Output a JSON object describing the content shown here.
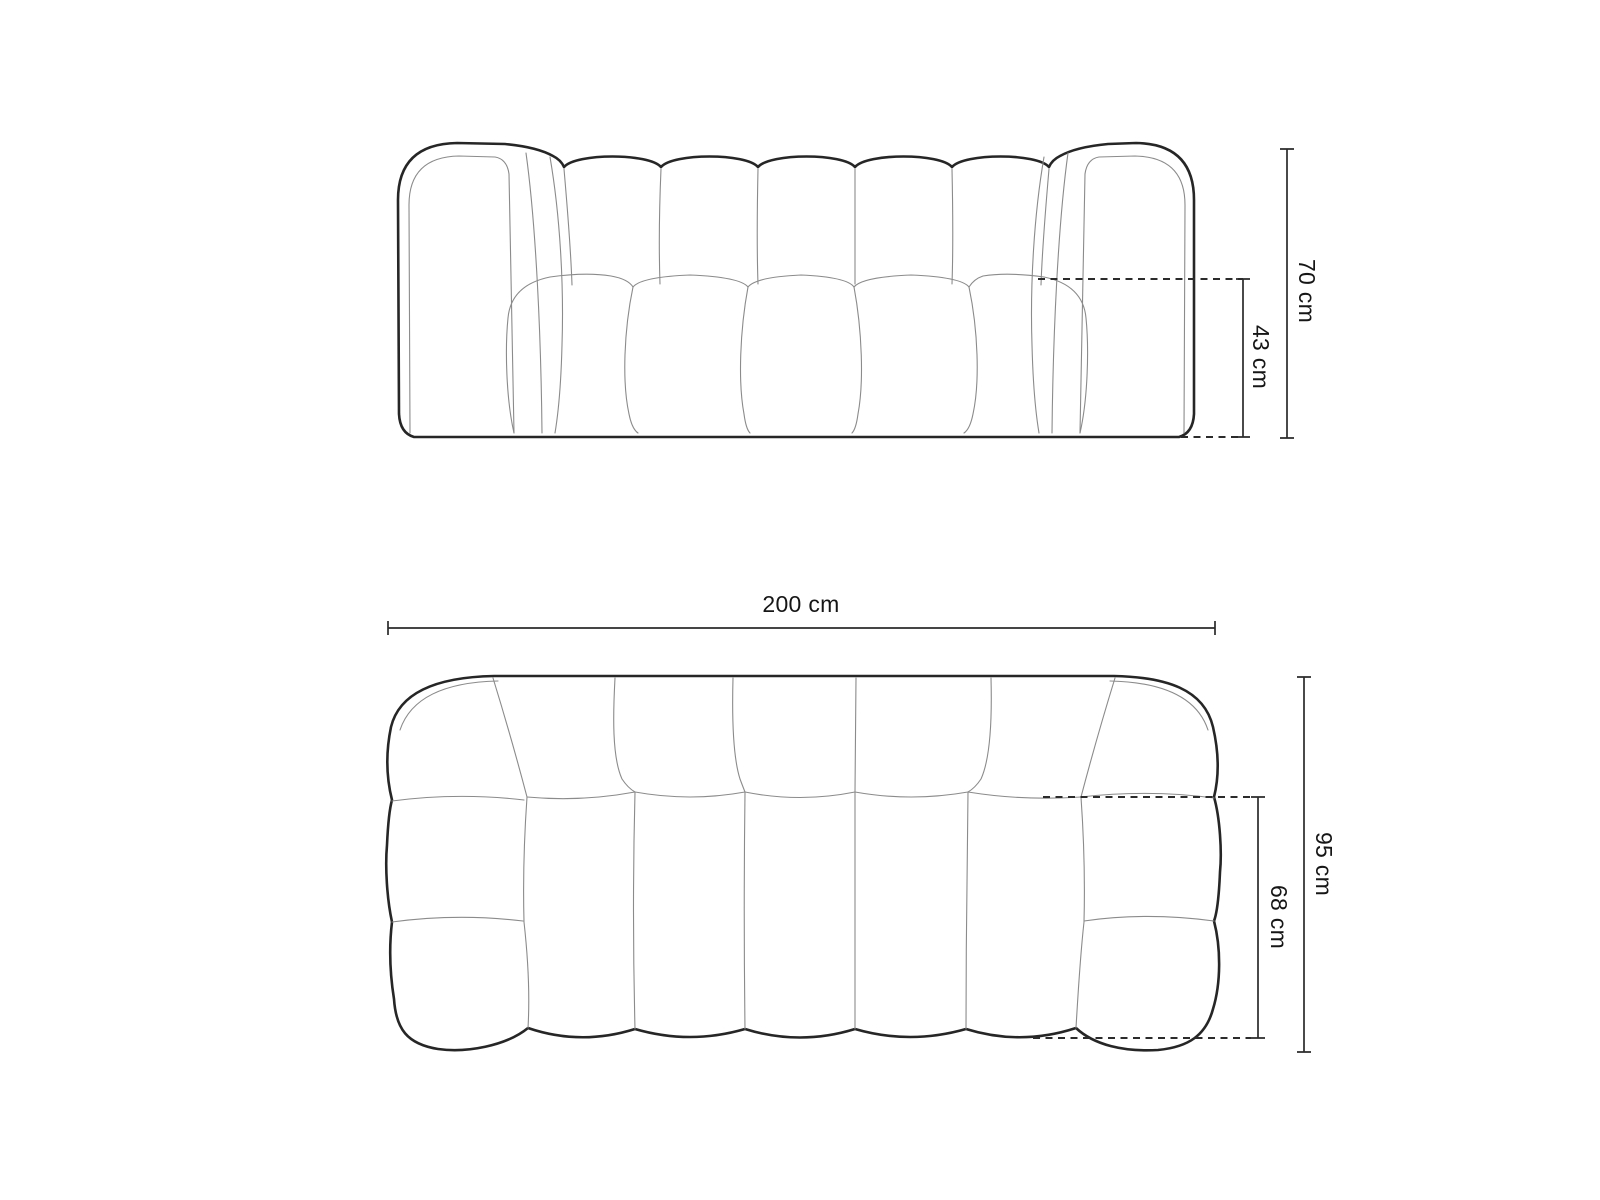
{
  "colors": {
    "background": "#ffffff",
    "outline": "#262626",
    "detail_line": "#8b8b8b",
    "dimension_line": "#2b2b2b",
    "label_text": "#161616"
  },
  "views": {
    "front": {
      "dimensions": {
        "overall_height": "70 cm",
        "seat_height": "43 cm"
      }
    },
    "top": {
      "dimensions": {
        "overall_width": "200 cm",
        "overall_depth": "95 cm",
        "seat_depth": "68 cm"
      }
    }
  }
}
